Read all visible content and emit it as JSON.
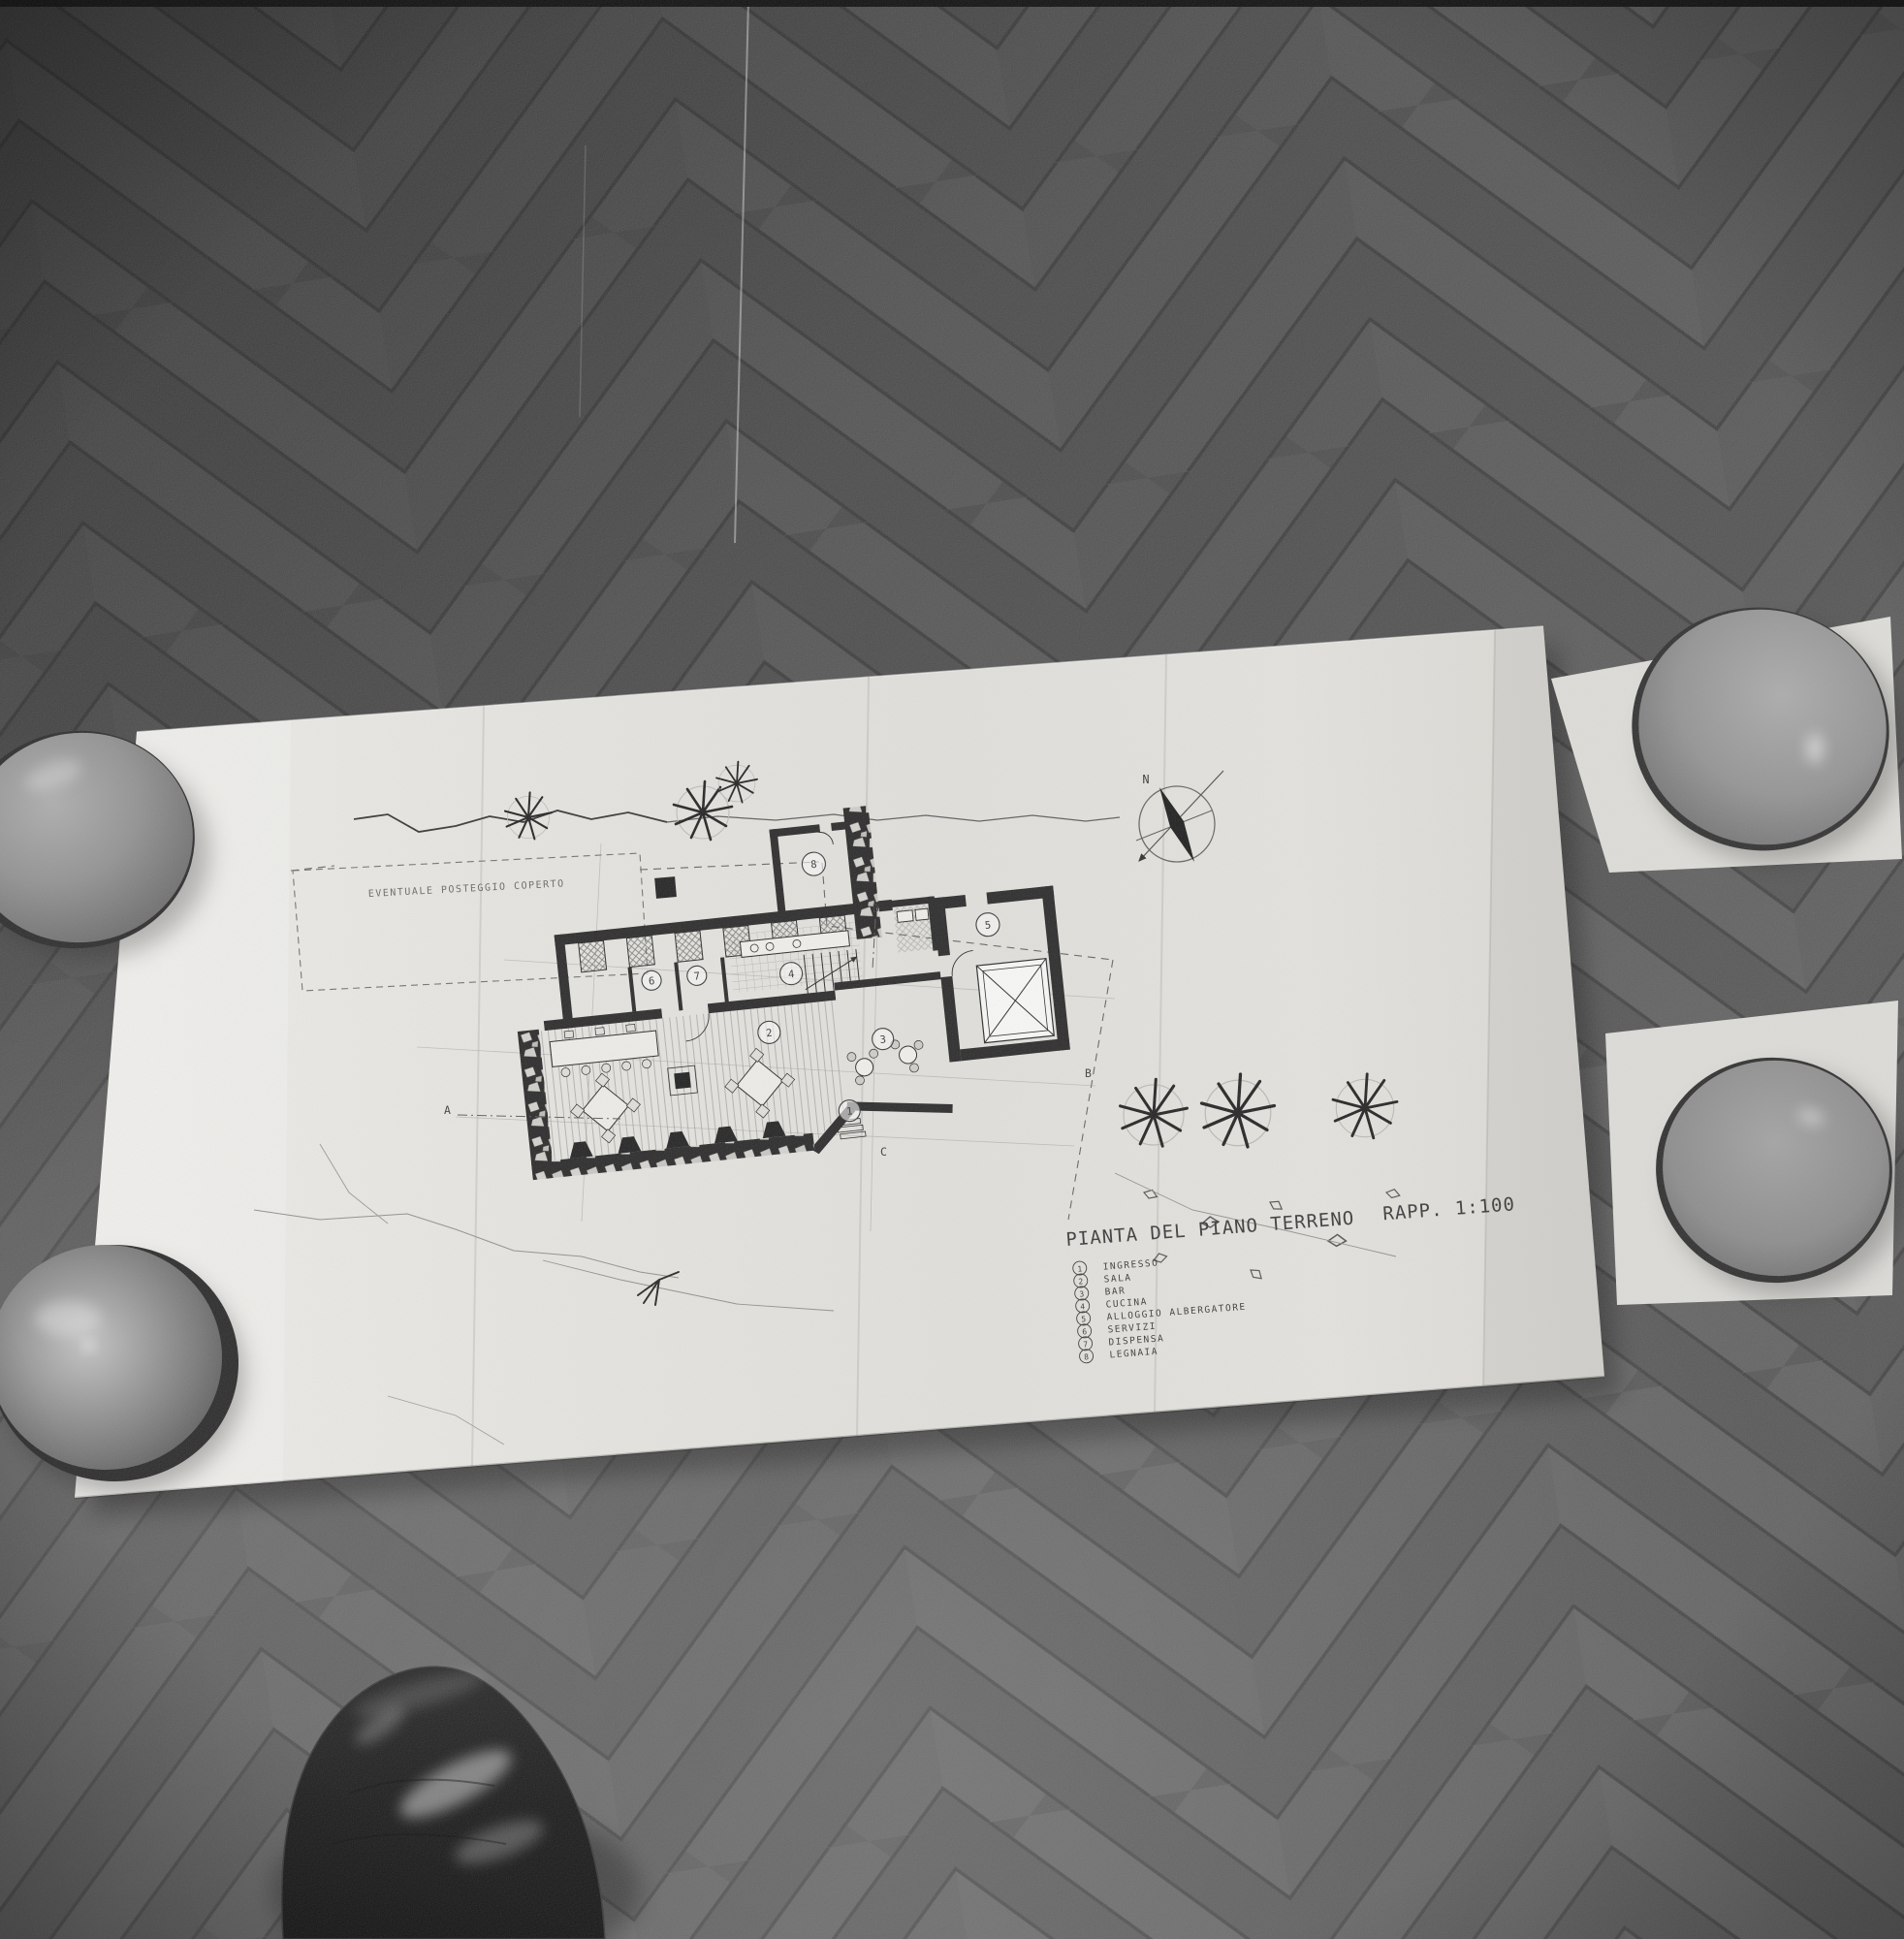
{
  "drawing": {
    "title": "PIANTA DEL PIANO TERRENO",
    "scale": "RAPP. 1:100",
    "site_note": "EVENTUALE POSTEGGIO COPERTO",
    "compass_north": "N",
    "section_markers": [
      "A",
      "B",
      "C",
      "D"
    ],
    "legend": {
      "items": [
        {
          "num": "1",
          "label": "INGRESSO"
        },
        {
          "num": "2",
          "label": "SALA"
        },
        {
          "num": "3",
          "label": "BAR"
        },
        {
          "num": "4",
          "label": "CUCINA"
        },
        {
          "num": "5",
          "label": "ALLOGGIO ALBERGATORE"
        },
        {
          "num": "6",
          "label": "SERVIZI"
        },
        {
          "num": "7",
          "label": "DISPENSA"
        },
        {
          "num": "8",
          "label": "LEGNAIA"
        }
      ]
    }
  },
  "colors": {
    "paper": "#e9e8e3",
    "ink": "#1d1d1d",
    "floor": "#4e4e4e",
    "bowl_gray": "#8d8d8d",
    "shoe_black": "#0a0a0a"
  }
}
